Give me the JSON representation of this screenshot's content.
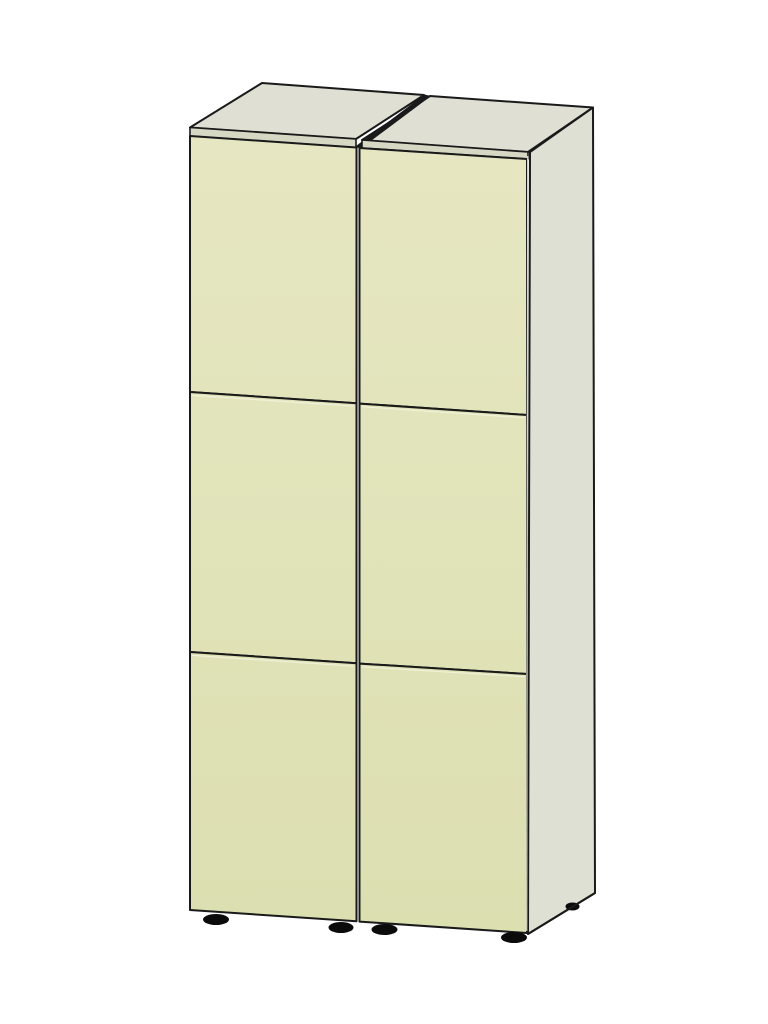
{
  "object": {
    "kind": "two-door cabinet, CAD-style 3D render",
    "doors": 2,
    "panels_per_door": 3,
    "visible_feet": 5
  },
  "colors": {
    "background": "#ffffff",
    "outline": "#1a1a1a",
    "door_top": "#e6e7c2",
    "door_bottom": "#dcdfb0",
    "top_panel": "#dfe0d3",
    "side_panel": "#dee0d3",
    "edge_strip": "#d6d8c4",
    "panel_gap": "#1a1a1a",
    "foot": "#0b0b0b",
    "seam_highlight": "#f0f1d8"
  }
}
